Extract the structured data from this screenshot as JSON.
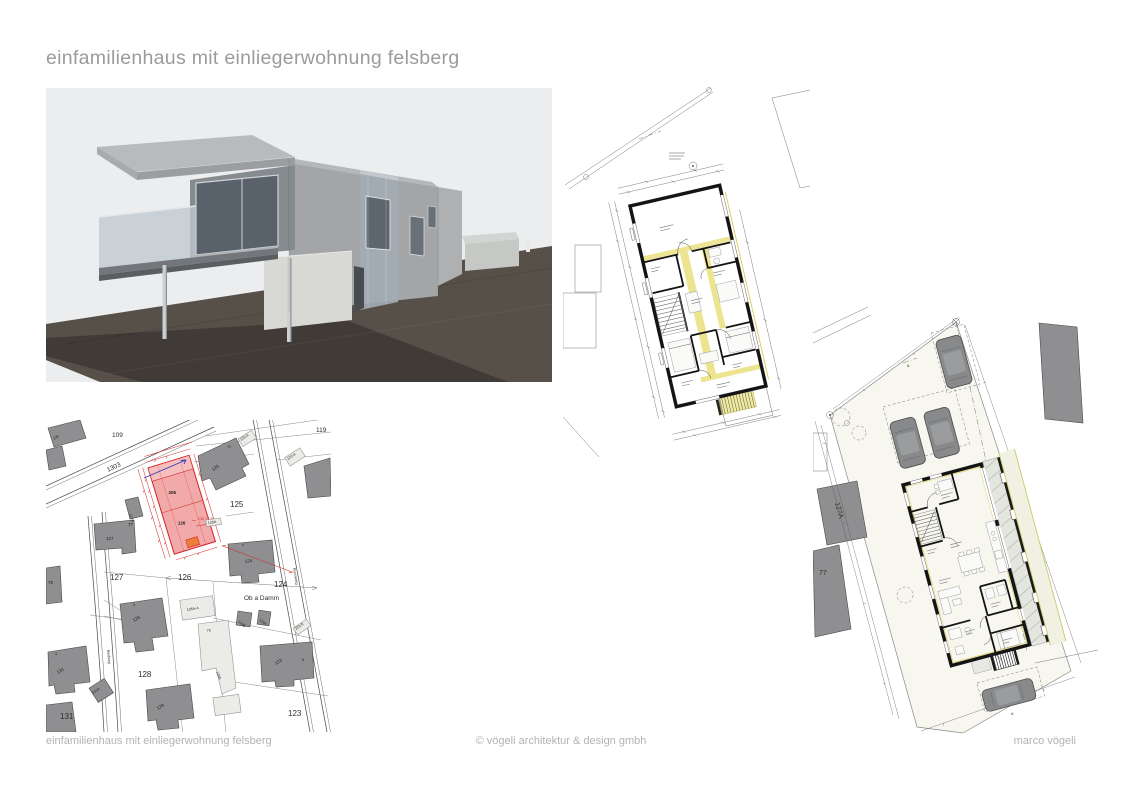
{
  "page": {
    "title": "einfamilienhaus mit einliegerwohnung felsberg"
  },
  "footer": {
    "left": "einfamilienhaus mit einliegerwohnung felsberg",
    "center": "© vögeli architektur & design gmbh",
    "right": "marco vögeli"
  },
  "colors": {
    "title_gray": "#9b9b9b",
    "footer_gray": "#b3b3b3",
    "highlight_pink": "#f2a9a9",
    "highlight_red": "#d42222",
    "highlight_orange": "#ee7f3b",
    "plan_yellow": "#ece48f",
    "ground_brown": "#575049",
    "building_gray": "#8f8f91"
  },
  "site_map": {
    "labels": {
      "p108": "108",
      "p109": "109",
      "p119": "119",
      "p1303": "1303",
      "p79": "79",
      "b73": "73",
      "b125": "125",
      "b125a": "125-A",
      "b120a": "120-A",
      "b127a": "127A",
      "b77": "77",
      "b127": "127",
      "pl125": "125",
      "box125a": "125A",
      "b4_124": "4",
      "b124": "124",
      "pl127": "127",
      "pl126": "126",
      "pl124": "124",
      "ob_a_damm": "Ob a Damm",
      "b126aa": "126A-A",
      "b124b": "124B",
      "b124a": "124A",
      "b223a": "223-A",
      "b75": "75",
      "b126a": "126A",
      "b3_128": "3",
      "b128": "128",
      "pl128": "128",
      "b4_131": "4",
      "b131": "131",
      "b131a": "131A",
      "b129": "129",
      "pl131": "131",
      "pl123": "123",
      "b123": "123",
      "b6_123": "6",
      "street_left": "Riedweg",
      "street_right": "Runcaweg",
      "hl_top": "206",
      "hl_bottom": "126",
      "red_dim": "1.52 + 1.50"
    }
  },
  "plan_lower": {
    "labels": {
      "neighbor_127a": "127A",
      "neighbor_77": "77",
      "section_a_top": "A",
      "section_a_bottom": "A"
    }
  }
}
